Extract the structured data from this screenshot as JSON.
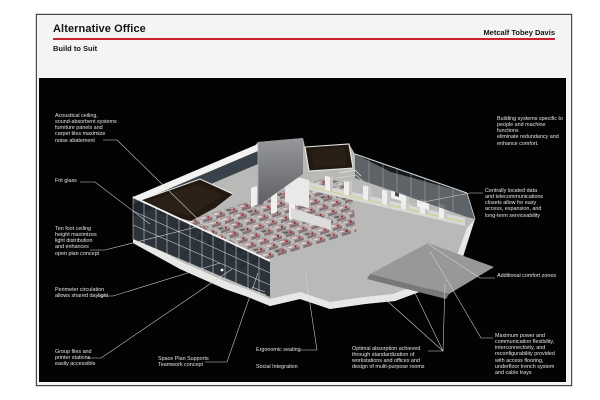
{
  "header": {
    "title": "Alternative Office",
    "firm": "Metcalf Tobey Davis",
    "subtitle": "Build to Suit"
  },
  "colors": {
    "accent_rule": "#c9232f",
    "panel_bg": "#030303",
    "annotation_text": "#e4e4e4",
    "leader_line": "#d6d6d6"
  },
  "annotations": [
    {
      "id": "acoustical-ceiling",
      "text": "Acoustical ceiling,\nsound-absorbent systems\nfurniture panels and\ncarpet tiles maximize\nnoise abatement"
    },
    {
      "id": "frit-glass",
      "text": "Frit glass"
    },
    {
      "id": "ten-foot-ceiling",
      "text": "Ten foot ceiling\nheight maximizes\nlight distribution\nand enhances\nopen plan concept"
    },
    {
      "id": "perimeter-circulation",
      "text": "Perimeter circulation\nallows shared daylight"
    },
    {
      "id": "group-files",
      "text": "Group files and\nprinter stations\neasily accessible"
    },
    {
      "id": "space-plan",
      "text": "Space Plan Supports\nTeamwork concept"
    },
    {
      "id": "ergonomic-seating",
      "text": "Ergonomic seating"
    },
    {
      "id": "social-integration",
      "text": "Social Integration"
    },
    {
      "id": "optimal-absorption",
      "text": "Optimal absorption achieved\nthrough standardization of\nworkstations and offices and\ndesign of multi-purpose rooms"
    },
    {
      "id": "building-systems",
      "text": "Building systems specific to\npeople and machine functions\neliminate redundancy and\nenhance comfort."
    },
    {
      "id": "central-data",
      "text": "Centrally located data\nand telecommunications\nclosets allow for easy\naccess, expansion, and\nlong-term serviceability"
    },
    {
      "id": "comfort-zones",
      "text": "Additional comfort zones"
    },
    {
      "id": "maximum-power",
      "text": "Maximum power and\ncommunication flexibility,\ninterconnectivity, and\nreconfigurability provided\nwith access flooring,\nunderfloor trench system\nand cable trays"
    }
  ]
}
